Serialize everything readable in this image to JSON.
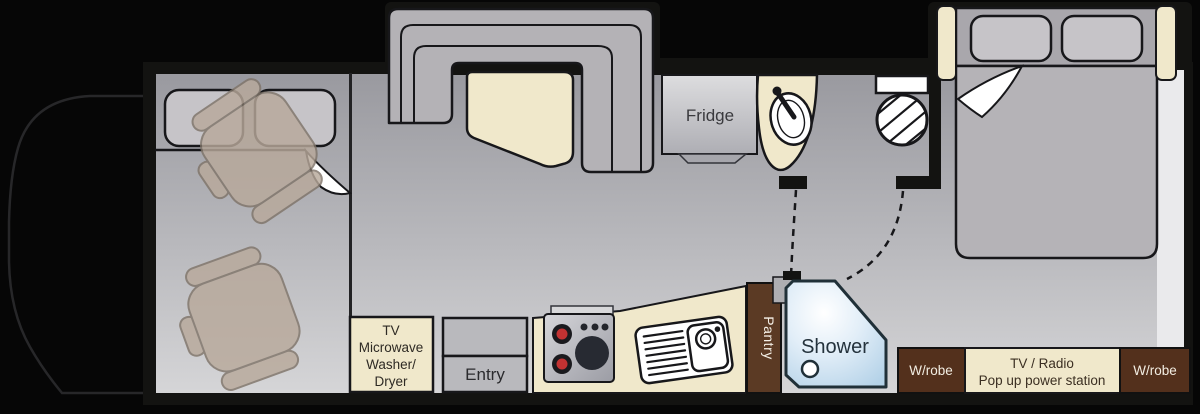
{
  "title": "Motorhome floor plan",
  "colors": {
    "background": "#060606",
    "walls": "#131311",
    "outline": "#17171a",
    "floor_top": "#9a9aa0",
    "floor_bottom": "#d4d4d6",
    "cream": "#f0e8cb",
    "brown": "#53301c",
    "pantry_brown": "#5b3a24",
    "tan_chair": "#b8a99b",
    "couch_gray": "#b4b2b6",
    "shower_blue": "#c2dcee",
    "stove_red": "#c23232",
    "label_dark": "#3a3a3e",
    "label_light": "#f2ede2"
  },
  "labels": {
    "kitchen": {
      "fridge": "Fridge",
      "pantry": "Pantry",
      "entry": "Entry"
    },
    "front_cabinet": {
      "line1": "TV",
      "line2": "Microwave",
      "line3": "Washer/",
      "line4": "Dryer"
    },
    "bathroom": {
      "shower": "Shower"
    },
    "bedroom": {
      "wardrobe_left": "W/robe",
      "wardrobe_right": "W/robe",
      "power_line1": "TV / Radio",
      "power_line2": "Pop up power station"
    }
  }
}
